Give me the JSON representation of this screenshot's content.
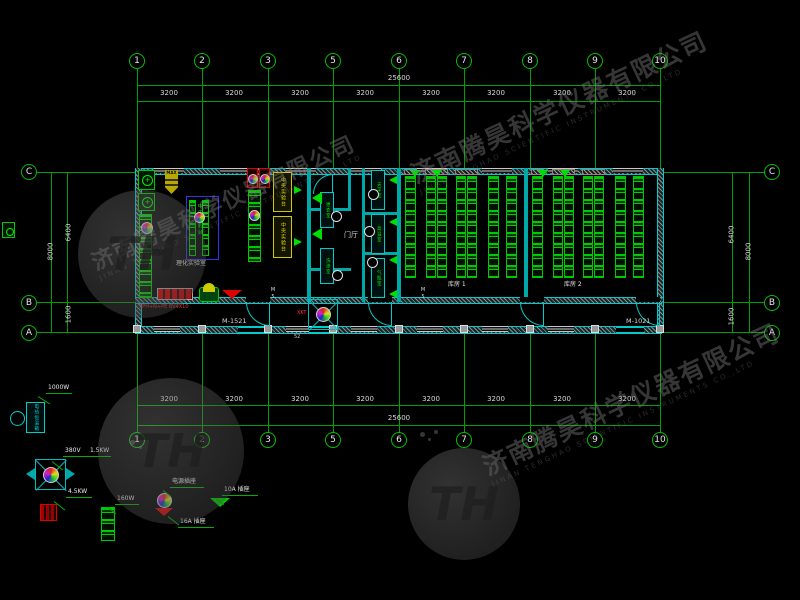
{
  "watermark": {
    "cn": "济南腾昊科学仪器有限公司",
    "en": "JINAN TENGHAO SCIENTIFIC INSTRUMENTS CO.,LTD",
    "logo": "TH"
  },
  "grid": {
    "cols": [
      "1",
      "2",
      "3",
      "5",
      "6",
      "7",
      "8",
      "9",
      "10"
    ],
    "rows": [
      "C",
      "B",
      "A"
    ],
    "bay_dim": "3200",
    "total_dim": "25600",
    "left": {
      "total": "8000",
      "upper": "6400",
      "lower": "1600"
    },
    "right": {
      "total": "8000",
      "upper": "6400",
      "lower": "1600"
    }
  },
  "rooms": {
    "lab": {
      "name": "理化实验室",
      "central_bench": "中央实验台"
    },
    "hall": {
      "name": "门厅"
    },
    "storage1": {
      "name": "库房 1"
    },
    "storage2": {
      "name": "库房 2"
    },
    "small_rooms": {
      "r1": "更衣室",
      "r2": "洗涤室",
      "r3": "天平室",
      "r4": "高温室",
      "r5": "气瓶室"
    }
  },
  "annotations": {
    "door_left": "M-1521",
    "door_right": "M-1021",
    "door_tag": "M5",
    "fan_tag": "XKT",
    "flag": "MAX",
    "mark": "52",
    "power_note": "3PH+N+PE BV4X10"
  },
  "legend": {
    "oven_label": "电热恒温箱",
    "oven_power": "1000W",
    "fan_voltage": "380V",
    "fan_power": "1.5KW",
    "heater_power": "4.5KW",
    "rack_power": "160W",
    "socket_main": "电源插座",
    "socket_16a": "16A 插座",
    "socket_10a": "10A 插座"
  }
}
